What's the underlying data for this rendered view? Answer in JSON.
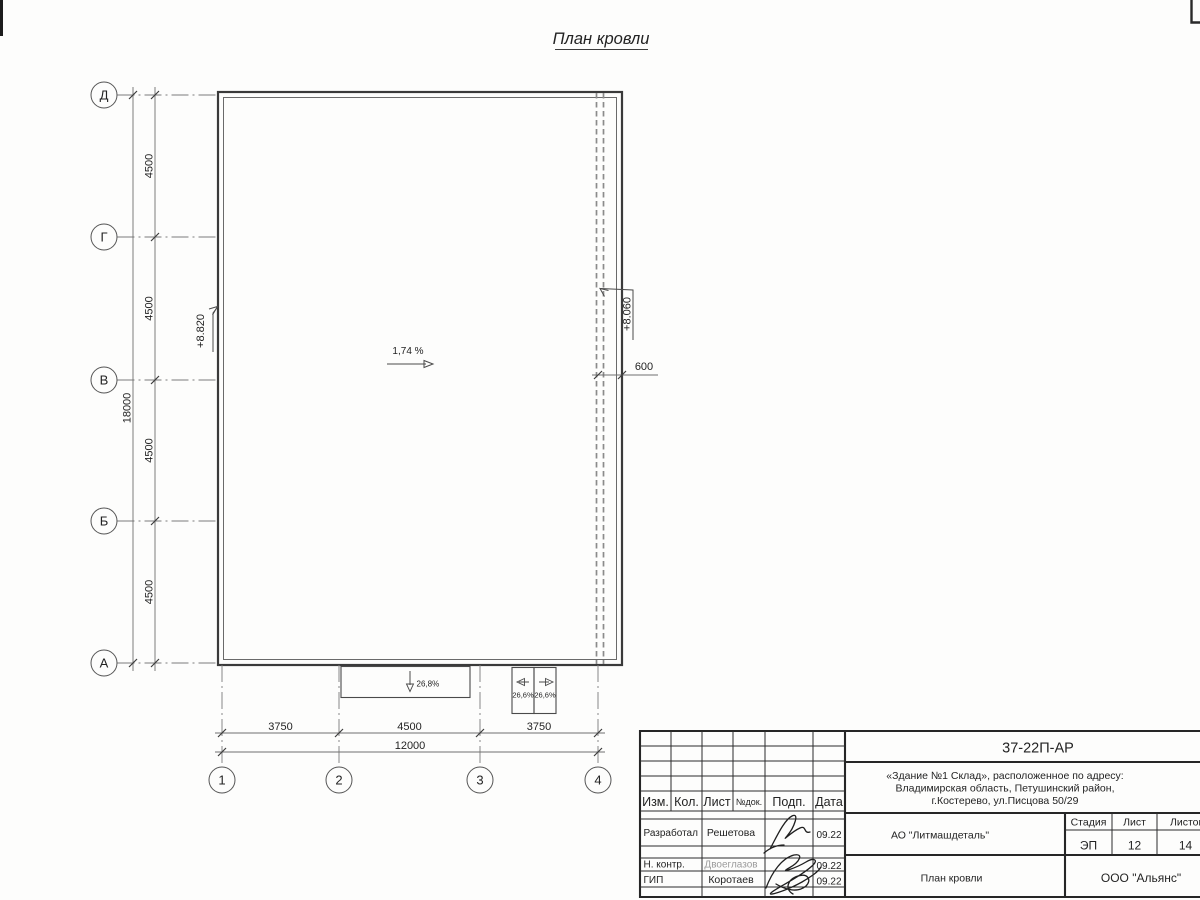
{
  "title": "План кровли",
  "axes": {
    "rows": [
      "Д",
      "Г",
      "В",
      "Б",
      "А"
    ],
    "cols": [
      "1",
      "2",
      "3",
      "4"
    ]
  },
  "dimensions": {
    "left_segments": [
      "4500",
      "4500",
      "4500",
      "4500"
    ],
    "left_total": "18000",
    "bottom_segments": [
      "3750",
      "4500",
      "3750"
    ],
    "bottom_total": "12000",
    "overhang": "600"
  },
  "annotations": {
    "elevation_left": "+8.820",
    "elevation_right": "+8.060",
    "roof_slope": "1,74 %",
    "canopy_slope": "26,8%",
    "canopy_slope_left": "26,6%",
    "canopy_slope_right": "26,6%"
  },
  "title_block": {
    "doc_number": "37-22П-АР",
    "project_address": {
      "line1": "«Здание №1 Склад», расположенное по адресу:",
      "line2": "Владимирская область, Петушинский район,",
      "line3": "г.Костерево, ул.Писцова 50/29"
    },
    "columns": [
      "Изм.",
      "Кол.",
      "Лист",
      "№док.",
      "Подп.",
      "Дата"
    ],
    "signature_rows": [
      {
        "role": "Разработал",
        "name": "Решетова",
        "date": "09.22"
      },
      {
        "role": "Н. контр.",
        "name": "Двоеглазов",
        "date": "09.22"
      },
      {
        "role": "ГИП",
        "name": "Коротаев",
        "date": "09.22"
      }
    ],
    "organization": "АО \"Литмашдеталь\"",
    "stage_label": "Стадия",
    "sheet_label": "Лист",
    "sheets_label": "Листов",
    "stage": "ЭП",
    "sheet": "12",
    "sheets": "14",
    "sheet_title": "План кровли",
    "company": "ООО \"Альянс\""
  },
  "colors": {
    "line": "#3a3a3a",
    "dashed_line": "#8b8b8b",
    "text": "#232323",
    "faded_text": "#9b9b9b",
    "background": "#fdfdfc"
  }
}
